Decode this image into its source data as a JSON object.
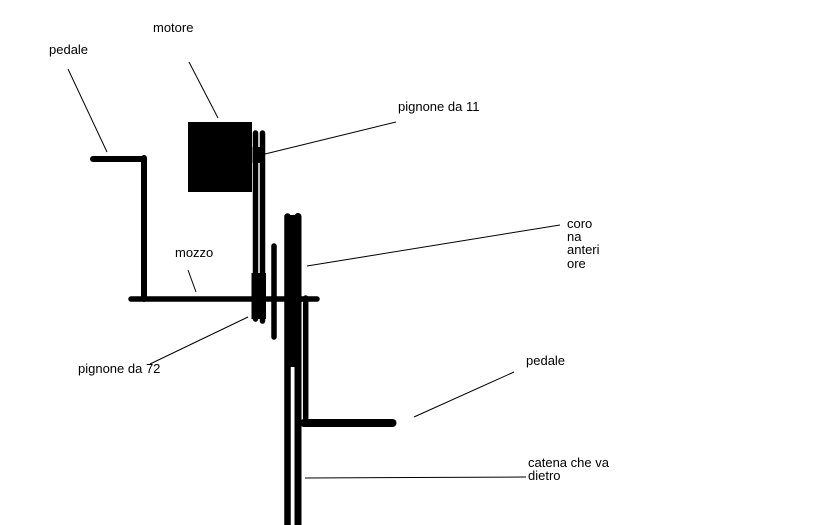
{
  "page": {
    "background": "#ffffff",
    "ink": "#000000"
  },
  "labels": {
    "pedal_left": "pedale",
    "motor": "motore",
    "sprocket_11": "pignone da 11",
    "hub": "mozzo",
    "chainring_front_lines": [
      "coro",
      "na",
      "anteri",
      "ore"
    ],
    "sprocket_72": "pignone da 72",
    "pedal_right": "pedale",
    "chain_rear_lines": [
      "catena che va",
      "dietro"
    ]
  }
}
